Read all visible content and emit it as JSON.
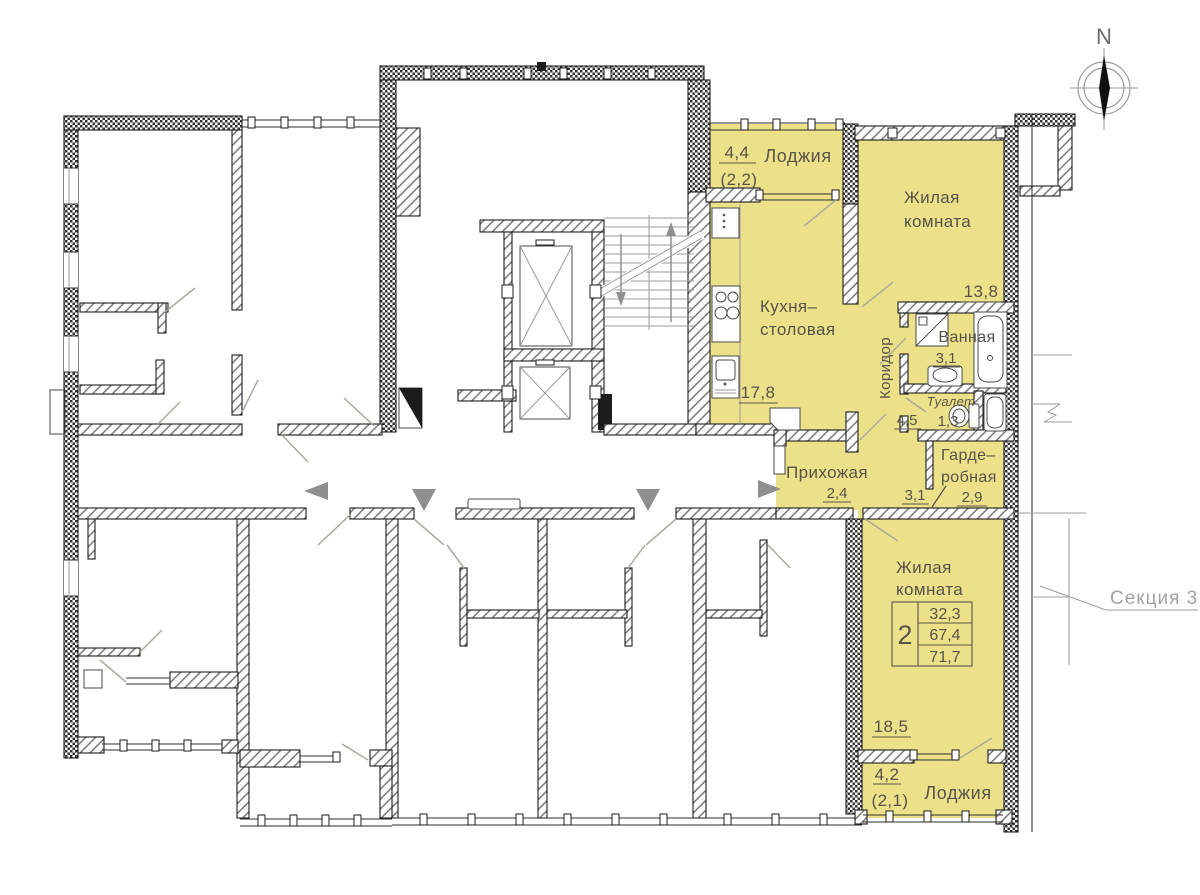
{
  "colors": {
    "highlight": "#ece189",
    "wall": "#1c1c1c",
    "label_text": "#57534c",
    "muted_text": "#a3a3a3",
    "arrow_gray": "#8f8f8f"
  },
  "compass": {
    "north_label": "N"
  },
  "section_callout": {
    "label": "Секция 3"
  },
  "apartment": {
    "summary": {
      "rooms_count": "2",
      "living_area": "32,3",
      "floor_area": "67,4",
      "total_area": "71,7"
    },
    "rooms": {
      "loggia_top": {
        "name": "Лоджия",
        "area": "4,4",
        "area_reduced": "(2,2)"
      },
      "living_top": {
        "name_line1": "Жилая",
        "name_line2": "комната",
        "area": "13,8"
      },
      "kitchen": {
        "name_line1": "Кухня–",
        "name_line2": "столовая",
        "area": "17,8"
      },
      "corridor": {
        "name": "Коридор",
        "area": "4,5"
      },
      "bathroom": {
        "name": "Ванная",
        "area": "3,1"
      },
      "wc": {
        "name": "Туалет",
        "area": "1,3"
      },
      "wardrobe": {
        "name_line1": "Гарде–",
        "name_line2": "робная",
        "area_adjacent": "3,1",
        "area": "2,9"
      },
      "hallway": {
        "name": "Прихожая",
        "area": "2,4"
      },
      "living_bottom": {
        "name_line1": "Жилая",
        "name_line2": "комната",
        "area": "18,5"
      },
      "loggia_bottom": {
        "name": "Лоджия",
        "area": "4,2",
        "area_reduced": "(2,1)"
      }
    }
  }
}
